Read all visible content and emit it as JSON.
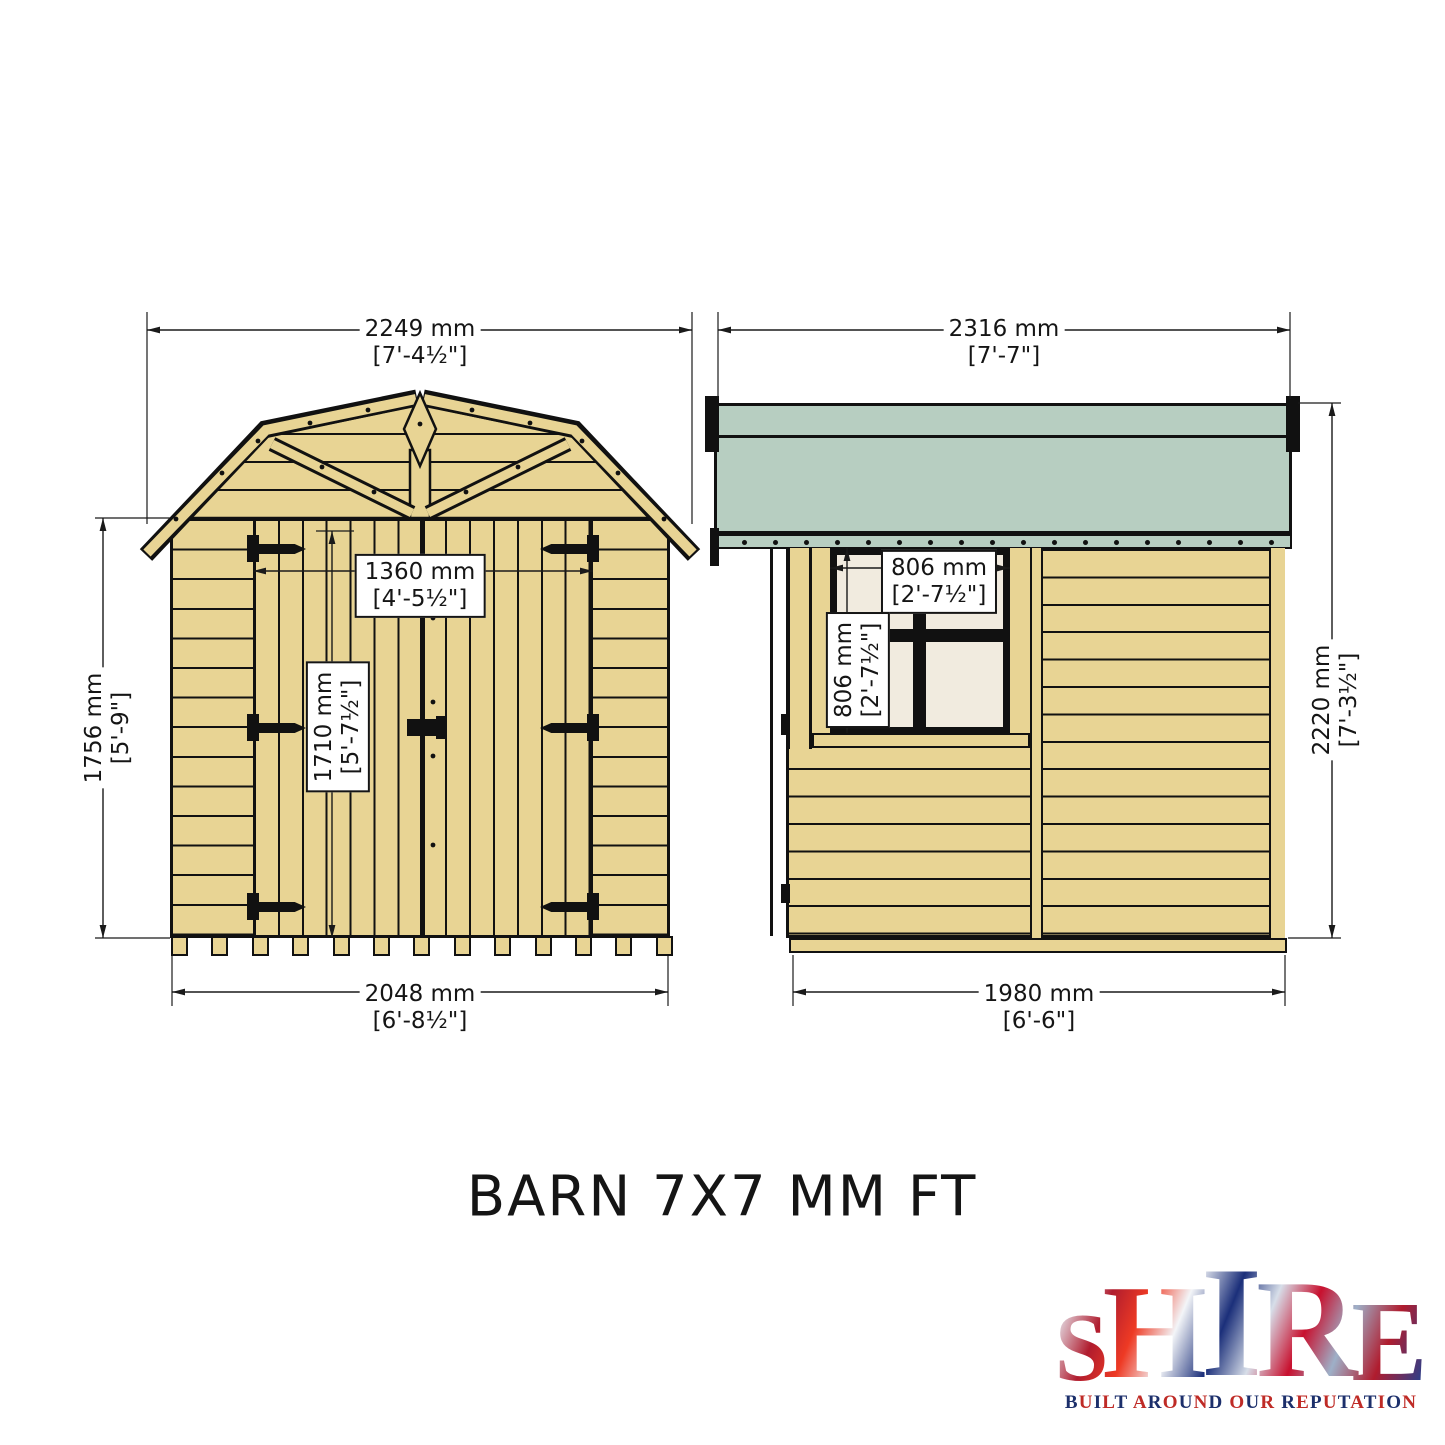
{
  "sheet": {
    "title": "BARN 7X7 MM FT"
  },
  "front_view": {
    "overall_width": {
      "mm": "2249 mm",
      "ft": "[7'-4½\"]"
    },
    "wall_height": {
      "mm": "1756 mm",
      "ft": "[5'-9\"]"
    },
    "door_width": {
      "mm": "1360 mm",
      "ft": "[4'-5½\"]"
    },
    "door_height": {
      "mm": "1710 mm",
      "ft": "[5'-7½\"]"
    },
    "base_width": {
      "mm": "2048 mm",
      "ft": "[6'-8½\"]"
    }
  },
  "side_view": {
    "overall_width": {
      "mm": "2316 mm",
      "ft": "[7'-7\"]"
    },
    "window_width": {
      "mm": "806 mm",
      "ft": "[2'-7½\"]"
    },
    "window_height": {
      "mm": "806 mm",
      "ft": "[2'-7½\"]"
    },
    "overall_height": {
      "mm": "2220 mm",
      "ft": "[7'-3½\"]"
    },
    "base_width": {
      "mm": "1980 mm",
      "ft": "[6'-6\"]"
    }
  },
  "logo": {
    "letters": [
      "S",
      "H",
      "I",
      "R",
      "E"
    ],
    "tagline": "BUILT AROUND OUR REPUTATION"
  },
  "colors": {
    "wood": "#e8d494",
    "roof_green": "#b7cec1",
    "window_pane": "#f1ebdf",
    "line": "#111111",
    "logo_navy": "#1c2f6b",
    "logo_red": "#bf2b26"
  }
}
